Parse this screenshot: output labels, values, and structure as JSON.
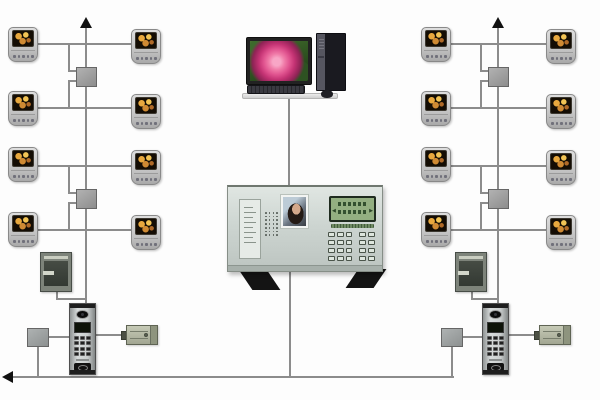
{
  "diagram": {
    "kind": "building-video-intercom-system-topology",
    "pc_workstation": {
      "parts": [
        "monitor",
        "desktop-tower",
        "keyboard",
        "mouse"
      ],
      "wallpaper": "pink-rose"
    },
    "management_console": {
      "parts": [
        "directory-panel",
        "speaker-grille",
        "video-portrait-screen",
        "lcd-display",
        "keypad",
        "stand-feet"
      ],
      "lcd": {
        "left_glyph": "◀",
        "right_glyph": "▶",
        "text_rows": 2
      },
      "keypad": {
        "rows": 4,
        "cols": 5,
        "gap_after_col": 3
      },
      "grille": {
        "rows": 7,
        "cols": 4
      },
      "directory_lines": 8
    },
    "indoor_monitor": {
      "screen_content": "orange-flowers",
      "buttons": 5
    },
    "door_station": {
      "parts": [
        "camera",
        "display-speaker",
        "keypad",
        "card-reader"
      ],
      "keypad": {
        "rows": 4,
        "cols": 3
      }
    },
    "risers": [
      {
        "id": "left",
        "trunk_arrow": "up",
        "distributors": 2,
        "monitor_columns": 2,
        "monitors_per_column": 4,
        "entrance": {
          "power_supply": true,
          "door_station": true,
          "junction_box": true,
          "electric_lock": true
        }
      },
      {
        "id": "right",
        "trunk_arrow": "up",
        "distributors": 2,
        "monitor_columns": 2,
        "monitors_per_column": 4,
        "entrance": {
          "power_supply": true,
          "door_station": true,
          "junction_box": true,
          "electric_lock": true
        }
      }
    ],
    "bus": {
      "arrow": "left",
      "connects": [
        "left-entrance-junction-box",
        "management-console",
        "right-entrance-junction-box"
      ]
    }
  },
  "colors": {
    "wire": "#8c8c8c",
    "arrow": "#111111",
    "junction_box": "#9c9c9c",
    "lcd_green": "#93af81",
    "rose_pink": "#e0538f",
    "flower_orange": "#e8a83e",
    "lock_olive": "#c6cab6",
    "console_body": "#cdd5d1"
  }
}
